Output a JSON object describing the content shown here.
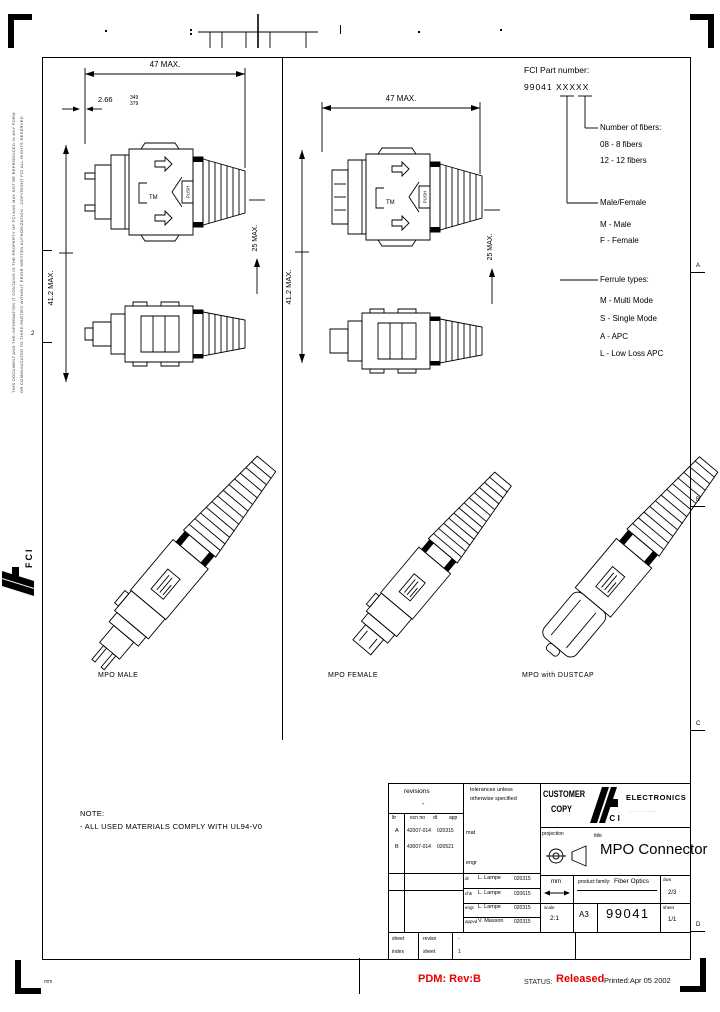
{
  "legend": {
    "title": "FCI Part number:",
    "part_number": "99041 XXXXX",
    "fibers_title": "Number of fibers:",
    "fibers_items": [
      "08 -  8 fibers",
      "12 - 12 fibers"
    ],
    "gender_title": "Male/Female",
    "gender_items": [
      "M - Male",
      "F - Female"
    ],
    "ferrule_title": "Ferrule types:",
    "ferrule_items": [
      "M - Multi Mode",
      "S - Single Mode",
      "A - APC",
      "L - Low Loss APC"
    ]
  },
  "dims": {
    "overall": "47 MAX.",
    "front": "2.66",
    "front_tol_top": "349",
    "front_tol_bot": "379",
    "length": "41.2 MAX.",
    "height": "25 MAX.",
    "tm": "TM",
    "push": "PUSH"
  },
  "views": {
    "male": "MPO MALE",
    "female": "MPO FEMALE",
    "dustcap": "MPO with DUSTCAP"
  },
  "note": {
    "title": "NOTE:",
    "body": "- ALL USED MATERIALS COMPLY WITH UL94-V0"
  },
  "zones": {
    "a": "A",
    "b": "B",
    "c": "C",
    "d": "D",
    "left_num": "2"
  },
  "title_block": {
    "revisions_header": "revisions",
    "revisions_dash": "-",
    "rev_cols": [
      "ltr",
      "ecn no",
      "dt",
      "app"
    ],
    "rev_rows": [
      {
        "ltr": "A",
        "ecn": "42007-014",
        "dt": "020315"
      },
      {
        "ltr": "B",
        "ecn": "43007-014",
        "dt": "020521"
      }
    ],
    "tolerances_1": "tolerances unless",
    "tolerances_2": "otherwise specified",
    "mat_label": "mat",
    "engr_label": "engr",
    "signoff": [
      {
        "role": "dr",
        "name": "L. Lampe",
        "date": "020315"
      },
      {
        "role": "chk",
        "name": "L. Lampe",
        "date": "020615"
      },
      {
        "role": "engr",
        "name": "L. Lampe",
        "date": "020315"
      },
      {
        "role": "appvd",
        "name": "V. Masson",
        "date": "020315"
      }
    ],
    "customer_1": "CUSTOMER",
    "customer_2": "COPY",
    "brand_name": "FCI",
    "brand_division": "ELECTRONICS",
    "brand_sub": "· · · · · · · · · · · ·",
    "projection_label": "projection",
    "title_label": "title",
    "drawing_title": "MPO Connector",
    "units": "mm",
    "product_family_label": "product family:",
    "product_family": "Fiber Optics",
    "dwn_label": "dwn",
    "page": "2/3",
    "scale_label": "scale",
    "scale": "2:1",
    "size": "A3",
    "drawing_number": "99041",
    "sheet_label": "sheet",
    "sheet": "1/1",
    "strip_row1": [
      "sheet",
      "revisn",
      "-"
    ],
    "strip_row2": [
      "index",
      "sheet",
      "1"
    ]
  },
  "status_bar": {
    "pdm": "PDM: Rev:B",
    "status_label": "STATUS:",
    "status_value": "Released",
    "printed": "Printed:Apr 05 2002",
    "units_note": "mm"
  },
  "margin": {
    "fine_print_1": "THIS DOCUMENT AND THE INFORMATION IT CONTAINS IS THE PROPERTY OF FCI AND MAY NOT BE REPRODUCED IN ANY FORM",
    "fine_print_2": "OR COMMUNICATED TO THIRD PARTIES WITHOUT PRIOR WRITTEN AUTHORIZATION - COPYRIGHT FCI ALL RIGHTS RESERVED",
    "logo": "FCI"
  },
  "colors": {
    "accent_red": "#e60000",
    "ink": "#000000"
  }
}
